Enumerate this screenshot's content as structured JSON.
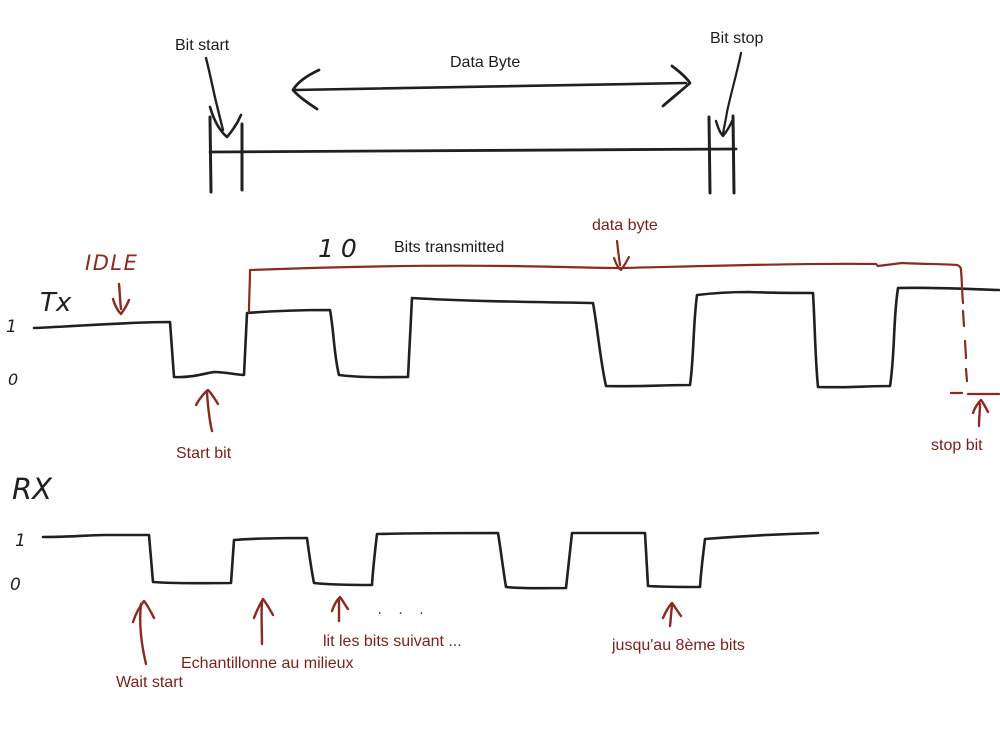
{
  "colors": {
    "ink": "#202020",
    "red_ink": "#8a2a22",
    "red_text": "#7c1f1a",
    "background": "#ffffff"
  },
  "top_diagram": {
    "bit_start_label": "Bit start",
    "data_byte_label": "Data Byte",
    "bit_stop_label": "Bit stop"
  },
  "tx": {
    "idle_label": "IDLE",
    "signal_label": "Tx",
    "level_high": "1",
    "level_low": "0",
    "bits_count": "10",
    "bits_transmitted_label": "Bits transmitted",
    "data_byte_label": "data byte",
    "start_bit_label": "Start bit",
    "stop_bit_label": "stop bit"
  },
  "rx": {
    "signal_label": "RX",
    "level_high": "1",
    "level_low": "0",
    "wait_start_label": "Wait start",
    "sample_label": "Echantillonne au milieux",
    "read_next_label": "lit les bits suivant ...",
    "until_label": "jusqu'au 8ème bits",
    "ellipsis": ". . ."
  }
}
